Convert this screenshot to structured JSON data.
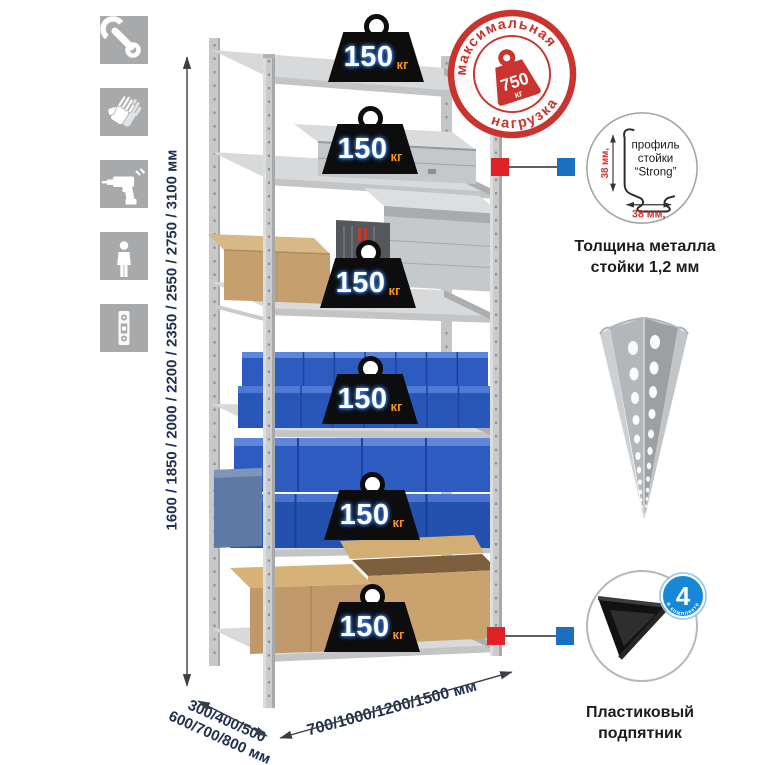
{
  "sidebar": {
    "icons": [
      {
        "name": "wrench-icon"
      },
      {
        "name": "gloves-icon"
      },
      {
        "name": "drill-icon"
      },
      {
        "name": "person-icon"
      },
      {
        "name": "level-icon"
      }
    ]
  },
  "dimensions": {
    "height_label": "1600 / 1850 / 2000 / 2200 / 2350 / 2550 / 2750 / 3100 мм",
    "depth_label_line1": "300/400/500",
    "depth_label_line2": "600/700/800 мм",
    "width_label": "700/1000/1200/1500 мм"
  },
  "shelf_load": {
    "value": "150",
    "unit": "кг"
  },
  "max_load_stamp": {
    "arc_top": "максимальная",
    "arc_bottom": "нагрузка",
    "value": "750",
    "unit": "кг"
  },
  "profile_detail": {
    "text_line1": "профиль",
    "text_line2": "стойки",
    "text_line3": "“Strong”",
    "dim_vertical": "38 мм,",
    "dim_horizontal": "38 мм,",
    "caption_line1": "Толщина металла",
    "caption_line2": "стойки 1,2 мм"
  },
  "foot_detail": {
    "badge_value": "4",
    "badge_text": "в комплекте",
    "caption_line1": "Пластиковый",
    "caption_line2": "подпятник"
  },
  "colors": {
    "stamp_red": "#c9342e",
    "callout_red": "#e02126",
    "callout_blue": "#1a6fc0",
    "badge_blue": "#1787d8",
    "navy_text": "#20304f",
    "weight_black": "#0d0d0d",
    "unit_orange": "#f7941d",
    "value_glow_blue": "#3b7fe0",
    "bin_blue": "#2d5bc0",
    "metal_gray": "#c9cbcd",
    "icon_tile_gray": "#a7a9ab",
    "dim_red": "#d2332c"
  }
}
